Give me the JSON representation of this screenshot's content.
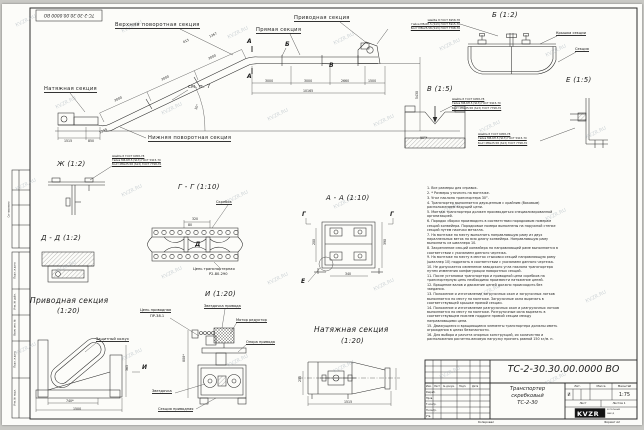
{
  "stamp": {
    "doc_number": "ТС-2-30.30.00.0000 ВО"
  },
  "watermark": {
    "text": "KVZR.RU"
  },
  "side_view": {
    "labels": {
      "upper_turn": "Верхняя поворотная секция",
      "straight": "Прямая секция",
      "drive": "Приводная секция",
      "tension": "Натяжная секция",
      "lower_turn": "Нижняя поворотная секция",
      "see_note": "см. п. 7",
      "angle": "30°"
    },
    "letters": {
      "a": "А",
      "b": "Б",
      "v": "В"
    },
    "dims": {
      "incline": [
        "3000",
        "3000",
        "3000"
      ],
      "d615": "615",
      "d1367": "1367",
      "horizontal": [
        "3000",
        "3000",
        "2660",
        "1500"
      ],
      "total": "10165",
      "height": "5430",
      "bottom1": "1515",
      "bottom2": "850",
      "diag": "1249"
    }
  },
  "fasteners": {
    "line1": "Шайба 8 ГОСТ 6958-78",
    "line2": "Гайка М8-6Н.5 (S13) ГОСТ 5915-70",
    "line3": "Болт М8х25.58 (S13) ГОСТ 7798-70"
  },
  "details": {
    "b": {
      "title": "Б (1:2)",
      "cover": "Крышка секции",
      "section": "Секция"
    },
    "v": {
      "title": "В (1:5)",
      "angle": "90°*"
    },
    "e": {
      "title": "Е (1:5)"
    },
    "zh": {
      "title": "Ж (1:2)"
    },
    "gg": {
      "title": "Г - Г (1:10)",
      "scraper": "Скребок",
      "chain1": "Цепь транспортерная",
      "chain2": "Р2-80-290",
      "dim320": "320",
      "dim80": "80",
      "letter_d": "Д"
    },
    "dd": {
      "title": "Д - Д (1:2)"
    },
    "aa": {
      "title": "А - А (1:10)",
      "letter_g": "Г",
      "letter_e": "Е",
      "dim_right": "390",
      "dim_left": "200",
      "dim_bottom": "340"
    }
  },
  "drive_section": {
    "title": "Приводная секция",
    "scale": "(1:20)",
    "casing": "Защитный кожух",
    "dim740": "740*",
    "dim1500": "1500",
    "dim365": "365",
    "letter_i": "И"
  },
  "view_i": {
    "title": "И (1:20)",
    "chain1": "Цепь приводная",
    "chain2": "ПР-38.1",
    "sprocket_drive": "Звездочка привода",
    "motor": "Мотор редуктор",
    "support": "Опора привода",
    "sprocket": "Звездочка",
    "section": "Секция приводная",
    "dim808": "808*"
  },
  "tension_section": {
    "title": "Натяжная секция",
    "scale": "(1:20)",
    "dim1515": "1515",
    "dim255": "255"
  },
  "notes": {
    "items": [
      "1. Все размеры для справок.",
      "2. * Размеры уточнить на монтаже.",
      "3. Угол наклона транспортера 30°.",
      "4. Транспортер выполняется двухцепным с крайним (боковым) расположением ведущей цепи.",
      "5. Монтаж транспортера должен производиться специализированной организацией.",
      "6. Порядок сборки производить в соответствии порядковым номерам секций конвейера. Порядковые номера выполнены на наружной стенке секций путем насечки металла.",
      "7. На монтаже по месту выполнить направляющую раму из двух параллельных веток на всю длину конвейера. Направляющую раму выполнить из швеллера 10.",
      "8. Закрепление секций конвейера на направляющей раме выполняется в соответствии с указанием данного чертежа.",
      "9. На монтаже по месту в местах стыковки секций направляющую раму (швеллер 10) подрезать в соответствии с указанием данного чертежа.",
      "10. Не допускается изменение заводского угла наклона транспортера путем изменения конфигурации поворотных секций.",
      "11. После установки транспортера и приводной цепи скребков на транспортерную цепь необходимо произвести натяжение цепей.",
      "12. Вращение валов и движение цепей должно происходить без заедания.",
      "13. Положение и изготовление загрузочных окон и загрузочных лотков выполняется по месту на монтаже. Загрузочные окна вырезать в соответствующей крышке прямой секции.",
      "14. Положение и изготовление разгрузочных окон и разгрузочных лотков выполняется по месту на монтаже. Разгрузочные окна вырезать в соответствующем нижнем поддоне прямой секции между направляющими цепи.",
      "15. Движущиеся и вращающиеся элементы транспортера должны иметь ограждения в целях безопасности.",
      "16. Для выбора и расчета опорных конструкций, их количества и расположения расчетно-весовую нагрузку принять равной 150 кг/м. п."
    ]
  },
  "title_block": {
    "doc_number": "ТС-2-30.30.00.0000  ВО",
    "name_line1": "Транспортер",
    "name_line2": "скребковый",
    "name_line3": "ТС-2-30",
    "col_lit": "Лит.",
    "col_mass": "Масса",
    "col_scale": "Масштаб",
    "lit_value": "И",
    "scale_value": "1:75",
    "sheet_label": "Лист",
    "sheets_label": "Листов 1",
    "header_cols": [
      "Изм.",
      "Лист",
      "№ докум.",
      "Подп.",
      "Дата"
    ],
    "rows": [
      "Разраб.",
      "Пров.",
      "Т.контр.",
      "Н.контр.",
      "Утв."
    ],
    "logo_text": "KVZR",
    "logo_sub1": "КОТЕЛЬНЫЙ",
    "logo_sub2": "ЗАВОД",
    "copied": "Копировал",
    "format": "Формат А2"
  },
  "frame": {
    "margin_labels": [
      "Подп. и дата",
      "Инв. № дубл.",
      "Взам. инв. №",
      "Подп. и дата",
      "Инв. № подл."
    ],
    "soglasovano": "Согласовано"
  }
}
